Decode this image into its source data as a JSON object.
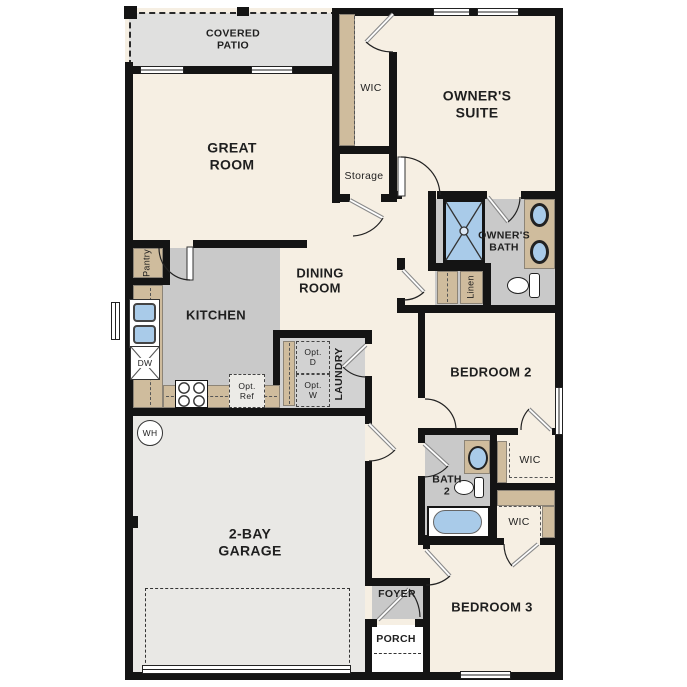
{
  "plan": {
    "labels": {
      "covered_patio": "COVERED PATIO",
      "great_room": "GREAT ROOM",
      "owner_wic": "WIC",
      "storage": "Storage",
      "owners_suite": "OWNER'S SUITE",
      "owners_bath": "OWNER'S BATH",
      "linen": "Linen",
      "pantry": "Pantry",
      "kitchen": "KITCHEN",
      "dining_room": "DINING ROOM",
      "dishwasher": "DW",
      "opt_d": "Opt. D",
      "opt_w": "Opt. W",
      "opt_ref": "Opt. Ref",
      "laundry": "LAUNDRY",
      "bedroom_2": "BEDROOM 2",
      "bath_2": "BATH 2",
      "bedroom2_wic": "WIC",
      "bedroom3_wic": "WIC",
      "water_heater": "WH",
      "garage": "2-BAY GARAGE",
      "foyer": "FOYER",
      "porch": "PORCH",
      "bedroom_3": "BEDROOM 3"
    },
    "colors": {
      "wall": "#141414",
      "floor_main": "#f6efe3",
      "floor_gray": "#c9c9c9",
      "floor_laundry": "#d2d2d2",
      "floor_garage": "#e9e8e5",
      "floor_patio": "#e0e0df",
      "counter_tan": "#cfbc9d",
      "fixture_blue": "#a9cbe9",
      "porch": "#ffffff"
    }
  }
}
